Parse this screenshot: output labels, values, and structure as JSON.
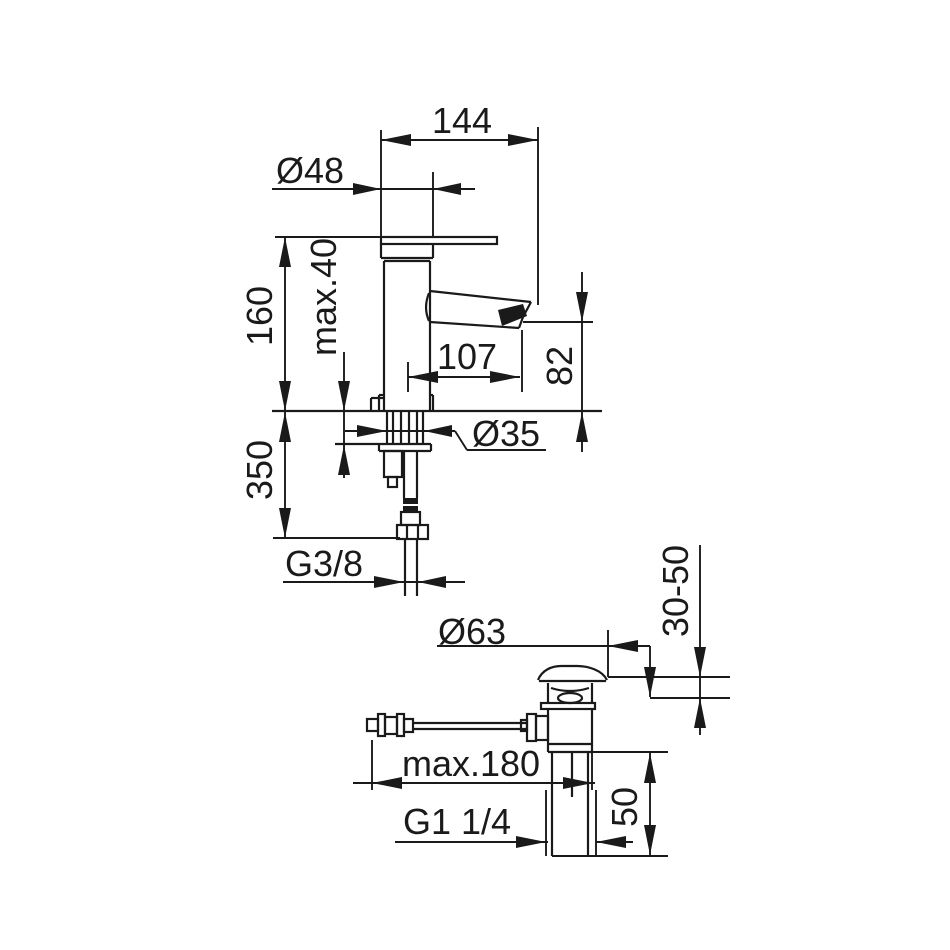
{
  "drawing": {
    "subject": "basin-mixer-faucet-dimension-diagram",
    "line_color": "#1a1a1a",
    "background_color": "#ffffff",
    "labels": {
      "overall_projection": "144",
      "body_diameter": "Ø48",
      "max_deck_thickness": "max.40",
      "body_height": "160",
      "spout_projection": "107",
      "spout_height": "82",
      "shank_diameter": "Ø35",
      "hose_length": "350",
      "supply_thread": "G3/8",
      "waste_cap_diameter": "Ø63",
      "basin_thickness_range": "30-50",
      "rod_length": "max.180",
      "waste_thread": "G1 1/4",
      "tailpiece_length": "50"
    }
  }
}
